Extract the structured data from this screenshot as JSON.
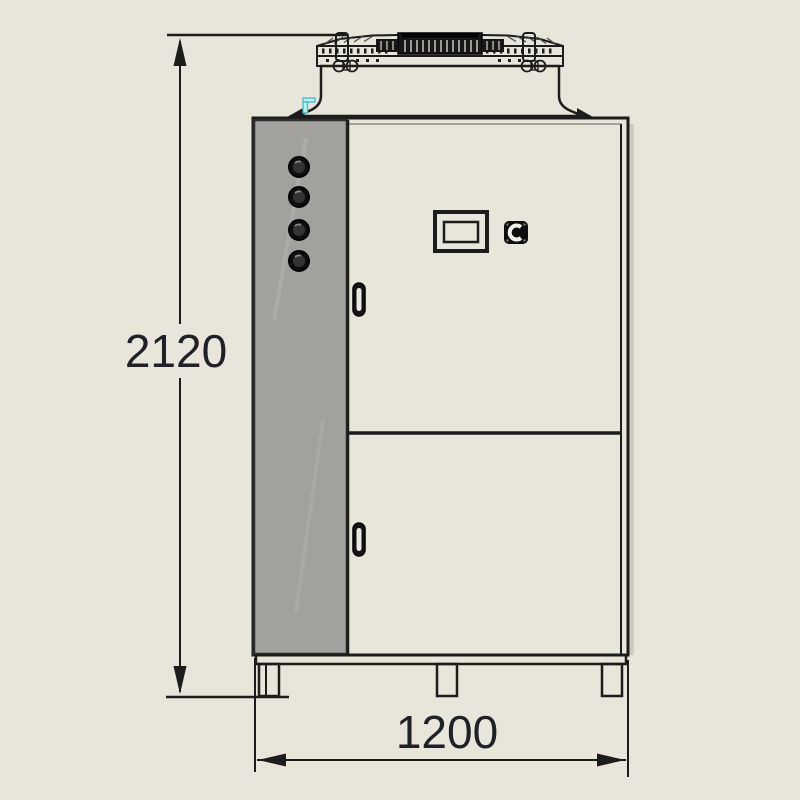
{
  "drawing": {
    "type": "technical-elevation",
    "subject": "industrial air-cooled chiller cabinet, front view with top fan cowling",
    "dimensions": {
      "height_label": "2120",
      "width_label": "1200"
    },
    "features": {
      "side_panel_knobs": 4,
      "doors": 2,
      "door_handles": 2,
      "feet": 3,
      "display_screen": 1,
      "power_switch": 1
    },
    "colors": {
      "background": "#e8e5da",
      "cabinet_fill": "#edebe1",
      "panel_fill": "#a2a19d",
      "panel_streak": "#b5b4b0",
      "band_fill": "#dedccf",
      "top_fill": "#d6d4c8",
      "grille_fill": "#171717",
      "slat_light": "#c9c7bb",
      "line": "#1c1c1c",
      "dim_text": "#1f2028",
      "accent_cyan": "#bfeef2",
      "accent_cyan_line": "#49b8c8",
      "shadow": "#cdcbc0"
    }
  }
}
